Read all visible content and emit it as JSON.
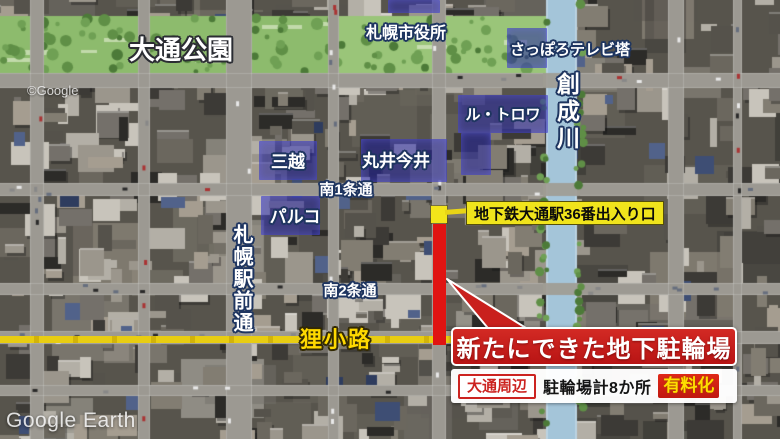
{
  "window": {
    "width": 780,
    "height": 439
  },
  "watermarks": {
    "google": "©Google",
    "google_earth": "Google Earth"
  },
  "map_labels": {
    "odori_park": "大通公園",
    "city_hall": "札幌市役所",
    "tv_tower": "さっぽろテレビ塔",
    "le_trois": "ル・トロワ",
    "sosei_river": "創成川",
    "mitsukoshi": "三越",
    "marui_imai": "丸井今井",
    "minami_1jo": "南1条通",
    "parco": "パルコ",
    "ekimae_dori": "札幌駅前通",
    "minami_2jo": "南2条通",
    "tanukikoji": "狸小路"
  },
  "callouts": {
    "subway_exit": "地下鉄大通駅36番出入り口",
    "headline": "新たにできた地下駐輪場",
    "area_badge": "大通周辺",
    "facility_count": "駐輪場計8か所",
    "paid_badge": "有料化"
  },
  "colors": {
    "headline_red": "#c9201d",
    "marker_yellow": "#f0e41c",
    "highlight_blue": "#2828a5",
    "tanukikoji_line_yellow": "#e3c50f",
    "river_blue": "#a4c5d9",
    "park_green": "#8dbb6d",
    "paid_text_yellow": "#ffdf00"
  }
}
